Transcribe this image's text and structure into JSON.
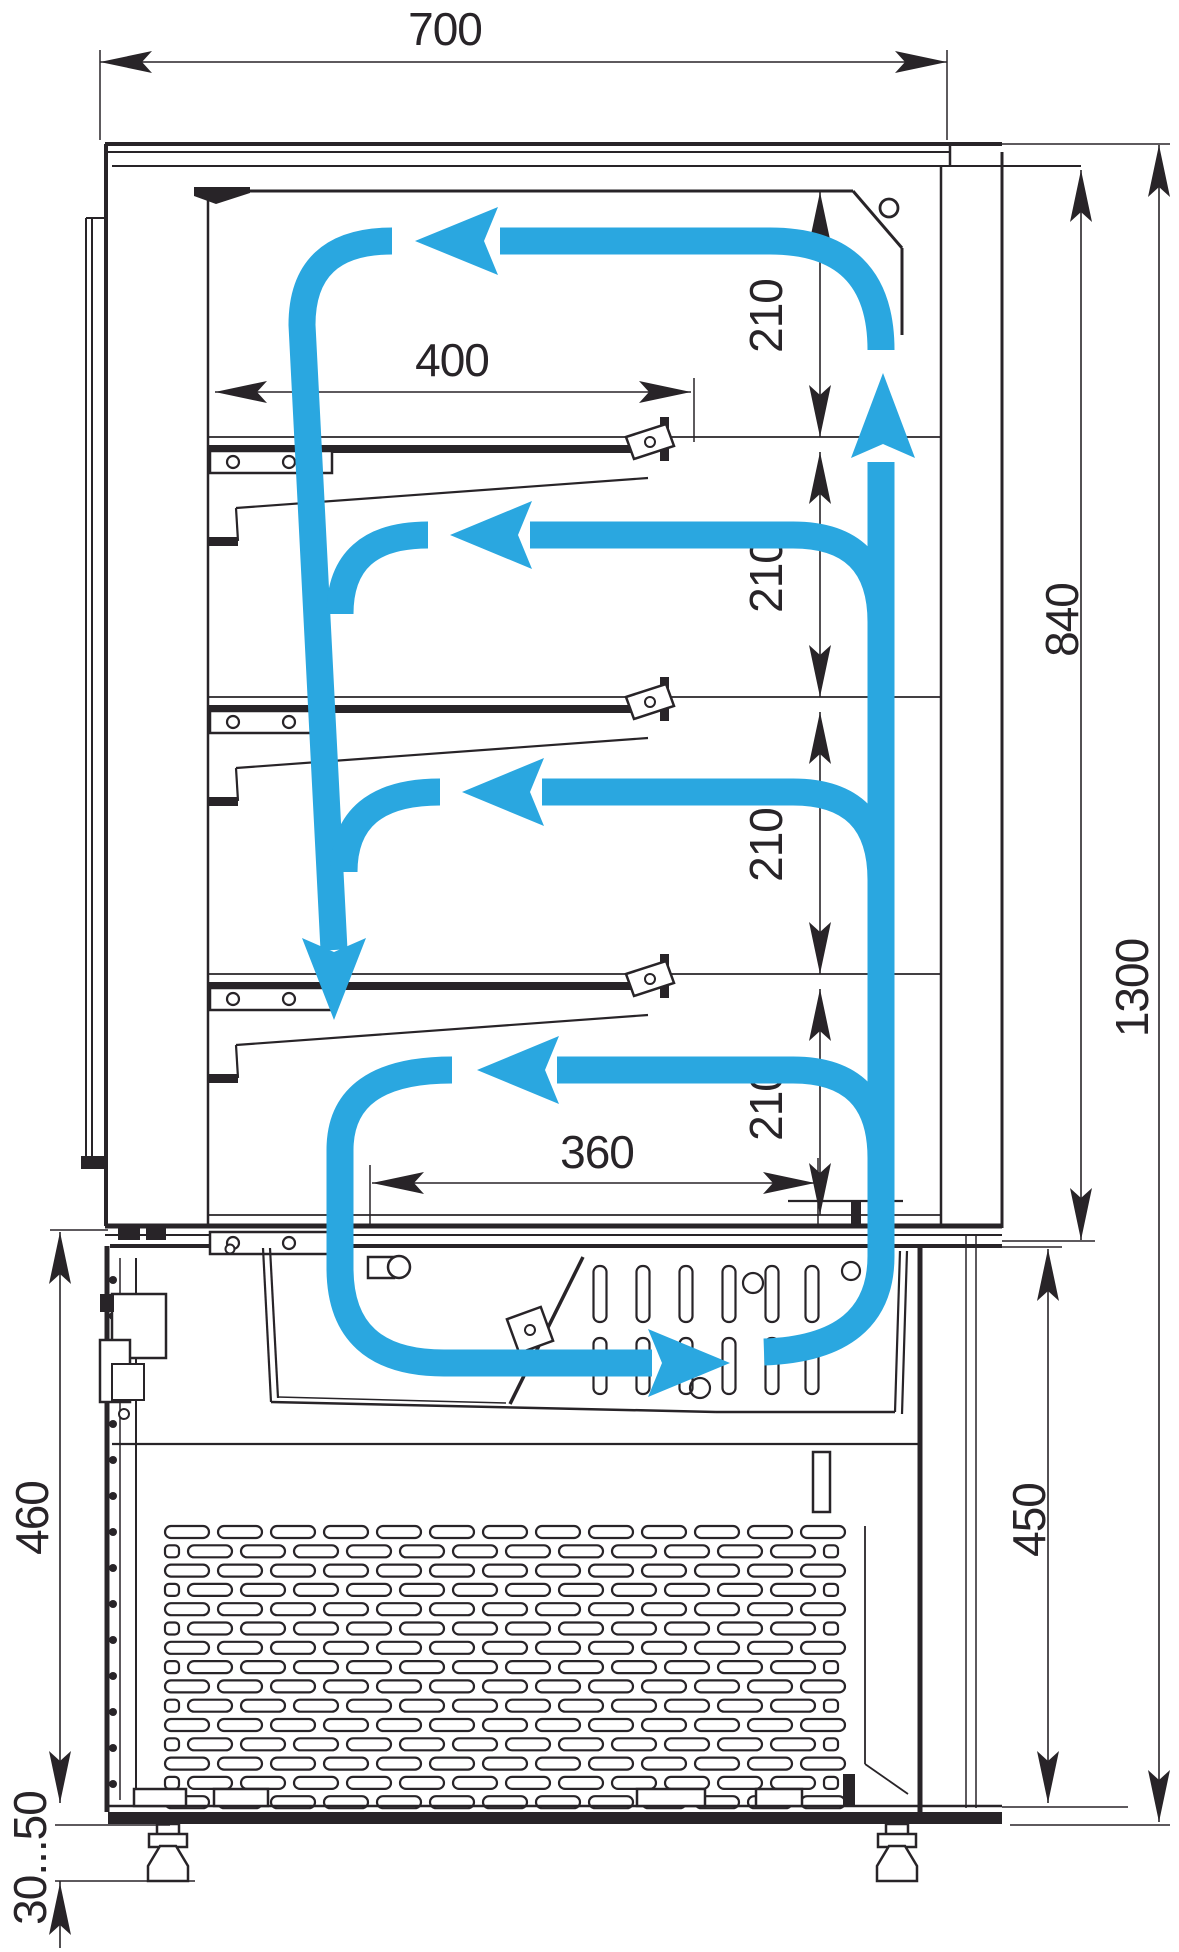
{
  "drawing": {
    "title": "Refrigerated confectionery display case — side section with air circulation",
    "colors": {
      "line": "#282428",
      "airflow": "#2aa7e0",
      "background": "#ffffff"
    },
    "dimensions": {
      "overall_width": {
        "label": "700"
      },
      "shelf_depth": {
        "label": "400"
      },
      "base_deck_depth": {
        "label": "360"
      },
      "shelf_pitch": {
        "label": "210",
        "count": 4
      },
      "display_height": {
        "label": "840"
      },
      "overall_height": {
        "label": "1300"
      },
      "base_right_height": {
        "label": "450"
      },
      "base_left_height": {
        "label": "460"
      },
      "leg_adjustment": {
        "label": "30...50"
      }
    },
    "airflow": {
      "arrowhead_count": 7,
      "description": "closed loop: air rises in rear duct, flows left over top and over each of 3 shelves, descends at glass front, returns right along evaporator basin"
    },
    "features": {
      "shelf_count": 3,
      "grille": "condenser ventilation grille",
      "feet": "2 adjustable feet"
    }
  }
}
